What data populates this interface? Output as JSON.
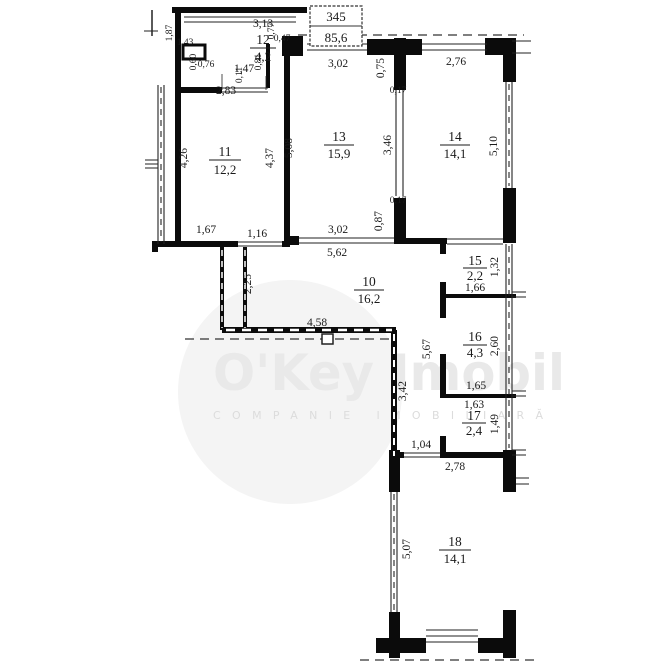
{
  "stamp": {
    "number": "345",
    "area": "85,6"
  },
  "watermark": {
    "brand": "O'Key Imobil",
    "subtitle": "COMPANIE IMOBILIARĂ"
  },
  "rooms": {
    "r10": {
      "num": "10",
      "area": "16,2"
    },
    "r11": {
      "num": "11",
      "area": "12,2"
    },
    "r12": {
      "num": "12",
      "area": "4,2"
    },
    "r13": {
      "num": "13",
      "area": "15,9"
    },
    "r14": {
      "num": "14",
      "area": "14,1"
    },
    "r15": {
      "num": "15",
      "area": "2,2"
    },
    "r16": {
      "num": "16",
      "area": "4,3"
    },
    "r17": {
      "num": "17",
      "area": "2,4"
    },
    "r18": {
      "num": "18",
      "area": "14,1"
    }
  },
  "dims": {
    "room12_width": "3,13",
    "room12_niche_w": "0,76",
    "room12_niche_h": "0,60",
    "balcony12_h": "1,87",
    "balcony12_w": "1,43",
    "room12_door": "1,47",
    "room12_door_jamb": "0,11",
    "room12_pier": "0,81",
    "entry_jog_h": "0,77",
    "entry_jog_w": "0,47",
    "room11_width": "2,83",
    "room11_left": "4,26",
    "room11_right": "4,37",
    "room11_pier": "1,67",
    "room11_door": "1,16",
    "room13_top": "3,02",
    "room13_left": "5,08",
    "room13_right": "3,46",
    "room13_bottom": "3,02",
    "room13_full": "5,62",
    "part1314_top": "0,75",
    "part1314_t1": "0,17",
    "part1314_t2": "0,17",
    "part1314_bottom": "0,87",
    "room14_top": "2,76",
    "room14_right": "5,10",
    "room15_right": "1,32",
    "room15_bottom": "1,66",
    "hall_passage": "2,25",
    "hall_width": "4,58",
    "hall_wall": "5,67",
    "hall_left": "3,42",
    "room16_right": "2,60",
    "room16_bottom": "1,65",
    "room17_top": "1,63",
    "room17_right": "1,49",
    "room18_door": "1,04",
    "room18_top": "2,78",
    "room18_left": "5,07"
  }
}
